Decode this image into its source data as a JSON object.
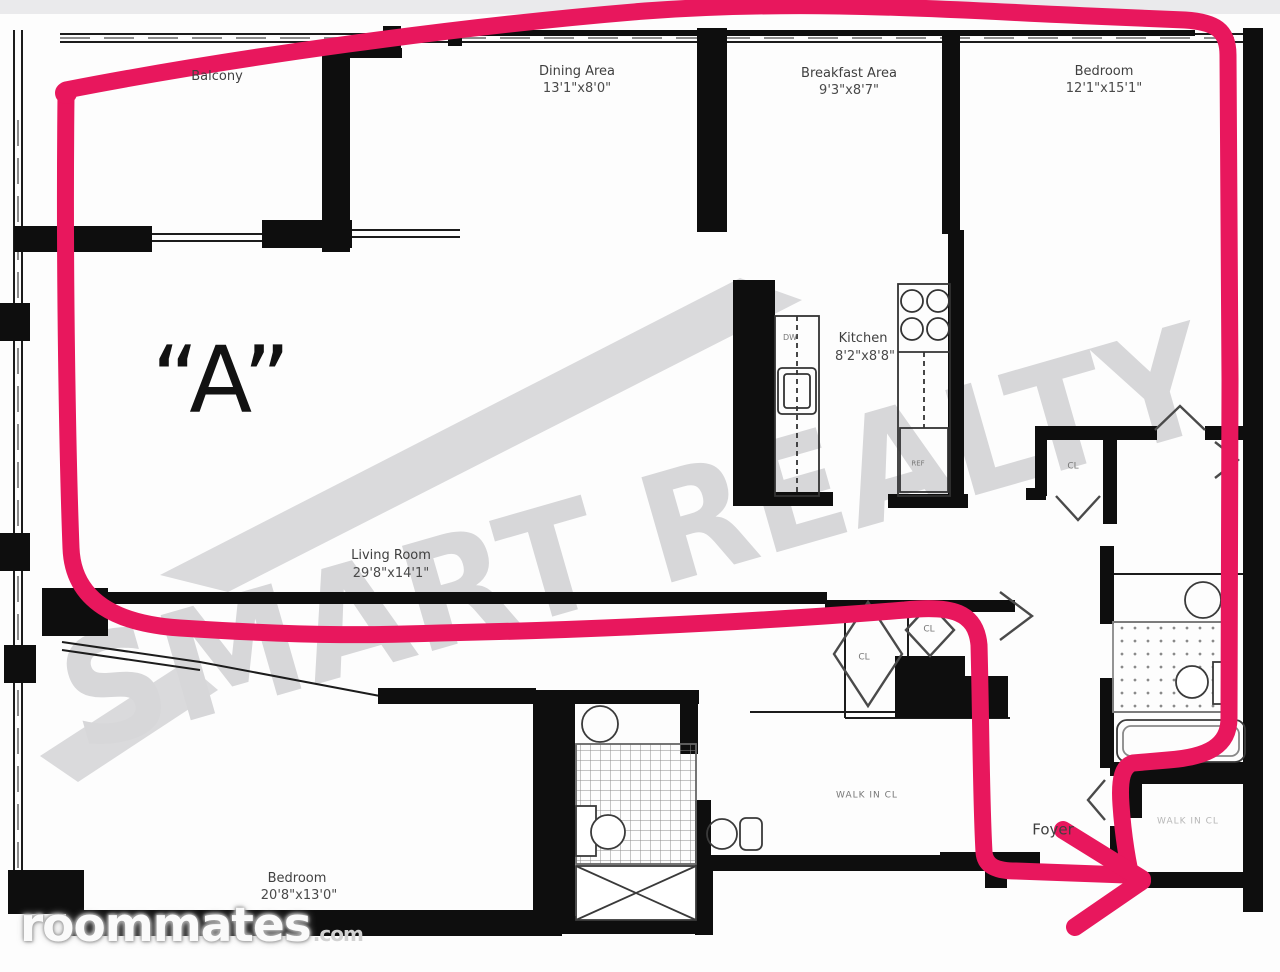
{
  "plan": {
    "unit_label": "“A”",
    "rooms": [
      {
        "name": "Balcony",
        "dims": ""
      },
      {
        "name": "Dining Area",
        "dims": "13'1\"x8'0\""
      },
      {
        "name": "Breakfast Area",
        "dims": "9'3\"x8'7\""
      },
      {
        "name": "Bedroom",
        "dims": "12'1\"x15'1\""
      },
      {
        "name": "Kitchen",
        "dims": "8'2\"x8'8\""
      },
      {
        "name": "Living Room",
        "dims": "29'8\"x14'1\""
      },
      {
        "name": "Bedroom",
        "dims": "20'8\"x13'0\""
      },
      {
        "name": "Foyer",
        "dims": ""
      },
      {
        "name": "WALK IN CL",
        "dims": ""
      }
    ],
    "fixtures": {
      "dishwasher": "DW",
      "refrigerator": "REF",
      "closet": "CL"
    }
  },
  "annotation": {
    "color": "#e8175d"
  },
  "watermarks": {
    "realty": "SMART REALTY",
    "site": "roommates",
    "tld": ".com"
  }
}
